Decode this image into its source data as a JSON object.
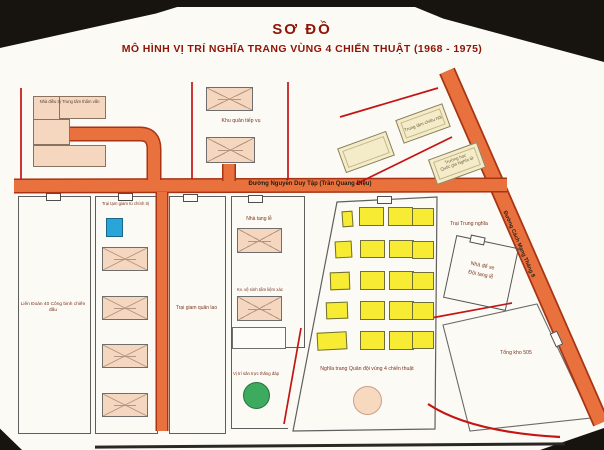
{
  "title": {
    "line1": "SƠ ĐỒ",
    "line2": "MÔ HÌNH VỊ TRÍ NGHĨA TRANG VÙNG 4 CHIẾN THUẬT (1968 - 1975)"
  },
  "roads": {
    "main_label": "Đường Nguyễn Duy Tập  (Trần Quang Diệu)",
    "right_label": "Đường Cách Mạng Tháng 8"
  },
  "areas": {
    "interrogation": "Nhà điều trị Trung tâm thẩm vấn",
    "supply": "Khu quân tiếp vụ",
    "chieu_hoi": "Trung tâm chiêu hồi",
    "school_line1": "Trường học",
    "school_line2": "Quốc gia Nghĩa tử",
    "engineer": "Liên Đoàn 40 Công binh chiến đấu",
    "political_prison": "Trại tạm giam tù chính trị",
    "military_prison": "Trại giam quân lao",
    "funeral_home": "Nhà tang lễ",
    "morgue": "Kv. vệ sinh tẩm liệm xác",
    "helipad": "Vị trí sân trực thăng đáp",
    "cemetery": "Nghĩa trang Quân đội vùng 4 chiến thuật",
    "trung_nghia": "Trại Trung nghĩa",
    "garage_line1": "Nhà để xe",
    "garage_line2": "Đội tang lễ",
    "depot": "Tổng kho 505"
  },
  "colors": {
    "road_orange": "#E8713E",
    "road_edge": "#A83414",
    "grave_yellow": "#F7EC33",
    "building_pink": "#F5D7C0",
    "building_cream": "#F4ECC8",
    "heliport_green": "#3CAB5E",
    "assembly_peach": "#F7D9BF",
    "blue_block": "#2AA5D8",
    "boundary_red": "#C41414",
    "title_red": "#8F1408"
  }
}
